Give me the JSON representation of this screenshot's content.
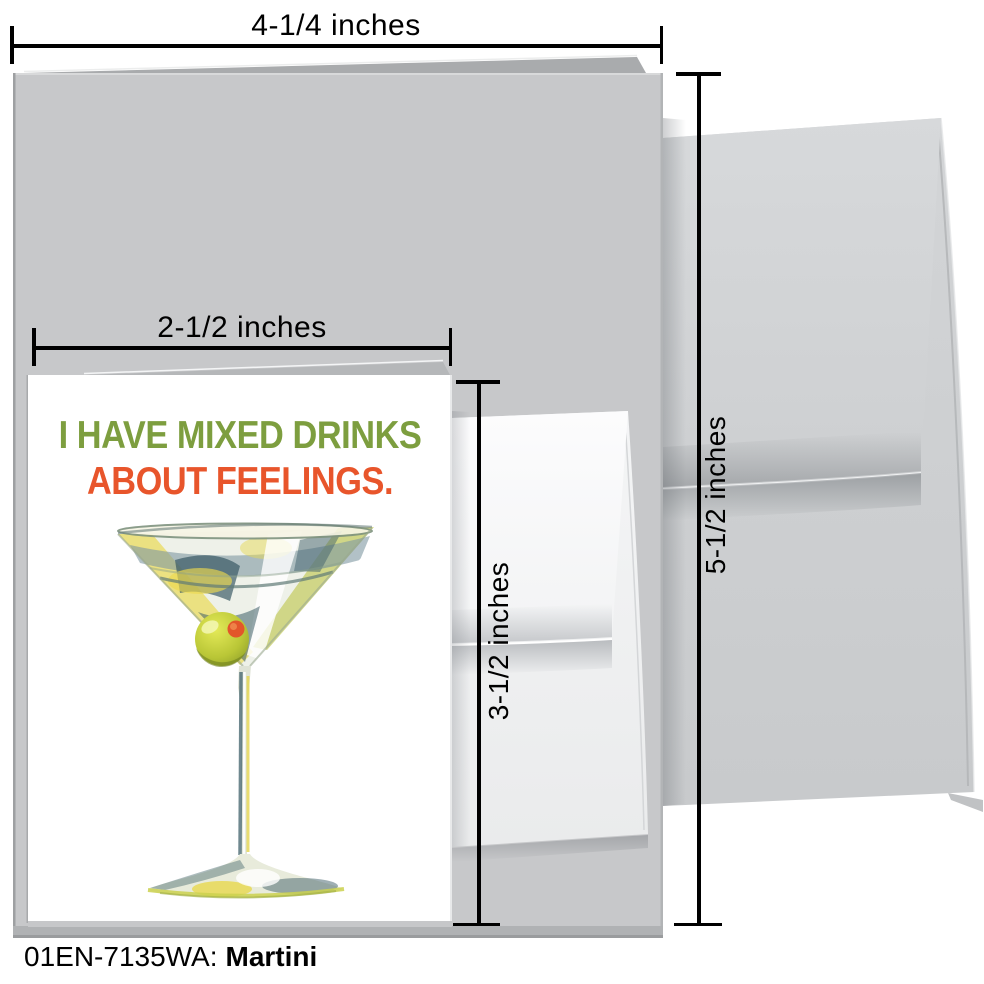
{
  "measurements": {
    "top_width": "4-1/4 inches",
    "small_card_width": "2-1/2 inches",
    "small_card_height": "3-1/2 inches",
    "large_card_height": "5-1/2 inches"
  },
  "card_front": {
    "line1": "I HAVE MIXED DRINKS",
    "line2": "ABOUT FEELINGS."
  },
  "caption": {
    "sku": "01EN-7135WA:",
    "name": "Martini"
  },
  "colors": {
    "headline_green": "#7d9e3f",
    "headline_orange": "#e8552b",
    "large_card_gray": "#c7c8ca",
    "envelope_gray": "#d0d2d4",
    "measure_line_black": "#000000",
    "olive_green": "#9fb02f",
    "pimento_red": "#e2562a"
  },
  "illustration": {
    "name": "watercolor martini glass with green olive and red pimento"
  }
}
